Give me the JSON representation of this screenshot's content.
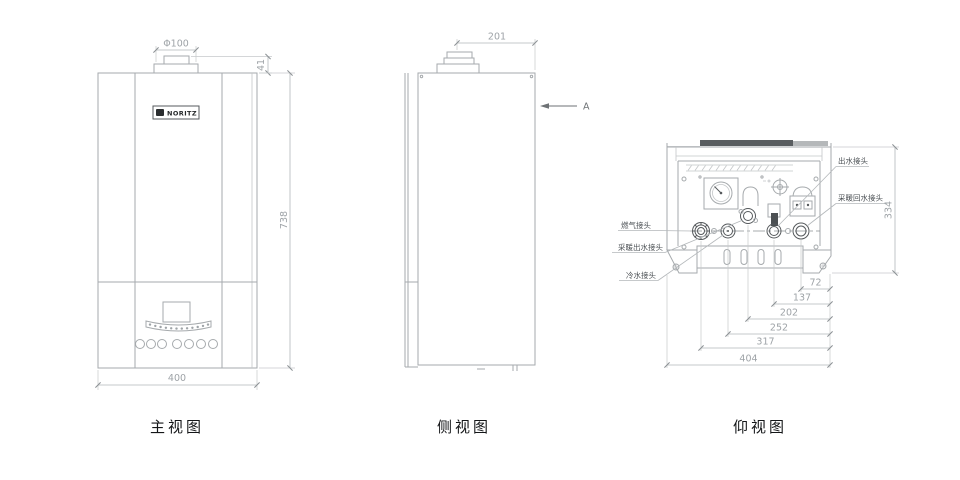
{
  "drawing": {
    "title_context": "wall-hung gas boiler three-view technical drawing",
    "views": {
      "front": {
        "caption": "主视图",
        "logo": "NORITZ",
        "dimensions": {
          "flue_diameter": "Φ100",
          "flue_height": "41",
          "body_height": "738",
          "body_width": "400"
        }
      },
      "side": {
        "caption": "侧视图",
        "view_arrow_label": "A",
        "dimensions": {
          "depth": "201"
        }
      },
      "bottom": {
        "caption": "仰视图",
        "connection_labels": {
          "gas": "燃气接头",
          "heating_outlet": "采暖出水接头",
          "cold_water": "冷水接头",
          "hot_water_outlet": "出水接头",
          "heating_return": "采暖回水接头"
        },
        "dimensions": {
          "heating_return_offset": "72",
          "hot_water_offset": "137",
          "heating_outlet_offset": "202",
          "cold_water_offset": "252",
          "gas_offset": "317",
          "bracket_width": "404",
          "panel_height": "334"
        }
      }
    },
    "colors": {
      "outline": "#a6aaad",
      "dark_detail": "#55595c",
      "dim_text": "#9ea3a7",
      "label_text": "#4b5054",
      "caption_text": "#141618",
      "top_bar_dark": "#595d60",
      "top_bar_light": "#b5b8ba",
      "background": "#ffffff"
    }
  }
}
